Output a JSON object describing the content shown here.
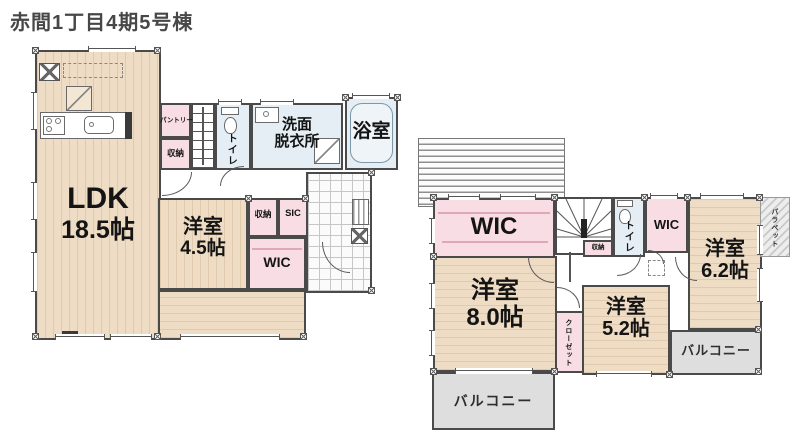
{
  "title": "赤間1丁目4期5号棟",
  "f1": {
    "ldk_name": "LDK",
    "ldk_size": "18.5帖",
    "yo45_name": "洋室",
    "yo45_size": "4.5帖",
    "pantry": "パントリー",
    "storage_a": "収納",
    "toilet": "トイレ",
    "wash_1": "洗面",
    "wash_2": "脱衣所",
    "bath": "浴室",
    "storage_b": "収納",
    "sic": "SIC",
    "wic": "WIC"
  },
  "f2": {
    "wic_main": "WIC",
    "storage": "収納",
    "toilet": "トイレ",
    "wic_sub": "WIC",
    "yo62_name": "洋室",
    "yo62_size": "6.2帖",
    "parapet": "パラペット",
    "yo80_name": "洋室",
    "yo80_size": "8.0帖",
    "closet": "クローゼット",
    "yo52_name": "洋室",
    "yo52_size": "5.2帖",
    "balcony_left": "バルコニー",
    "balcony_right": "バルコニー"
  },
  "colors": {
    "wall": "#4a4a4a",
    "wood_floor": "#eedcc4",
    "closet_pink": "#f8dde4",
    "wet_area_blue": "#e4eef4",
    "balcony_gray": "#dedede",
    "title_text": "#474747"
  }
}
